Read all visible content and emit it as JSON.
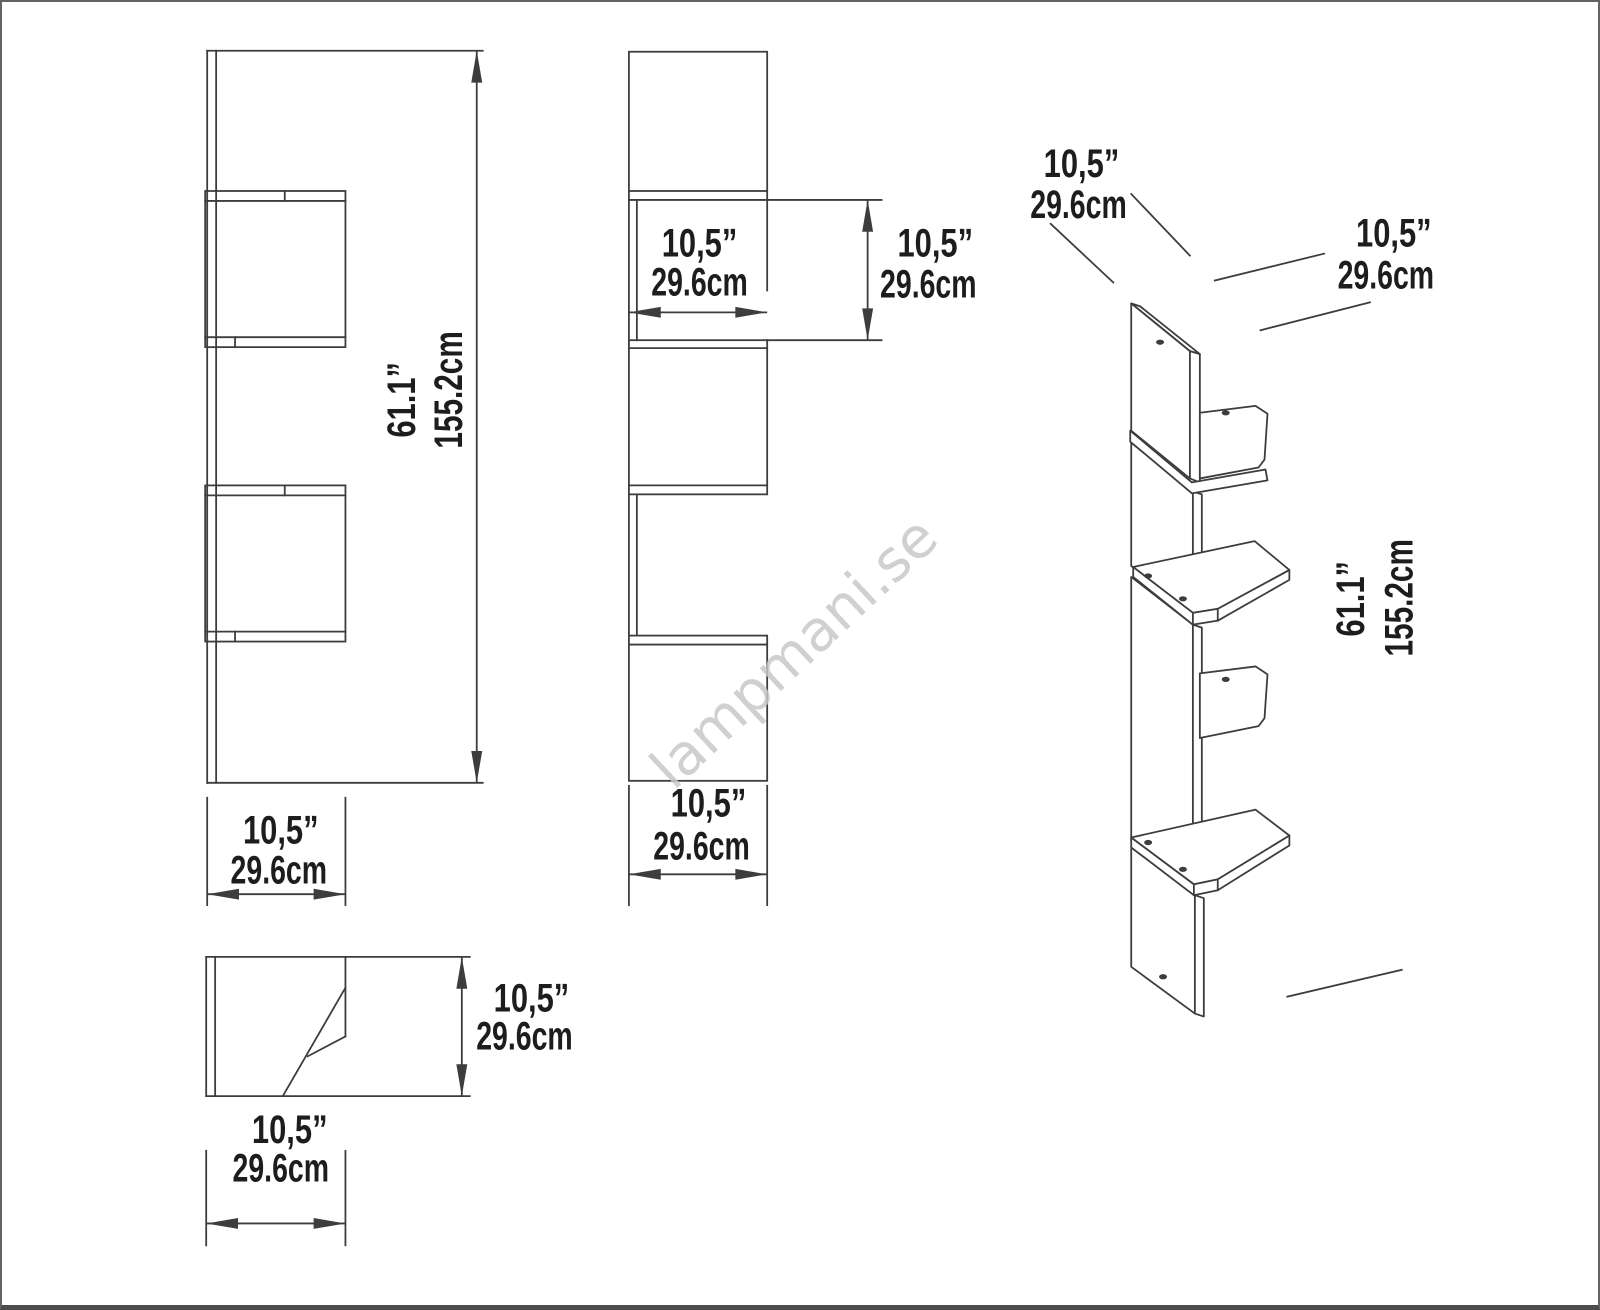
{
  "colors": {
    "line": "#3d3d3d",
    "text": "#1d1d1d",
    "watermark": "#c8c8c8",
    "background": "#ffffff",
    "border": "#636363",
    "border_bottom": "#4c4c4c"
  },
  "watermark": {
    "text": "lampmani.se"
  },
  "labels": {
    "width_in": "10,5”",
    "width_cm": "29.6cm",
    "height_in": "61.1”",
    "height_cm": "155.2cm"
  }
}
